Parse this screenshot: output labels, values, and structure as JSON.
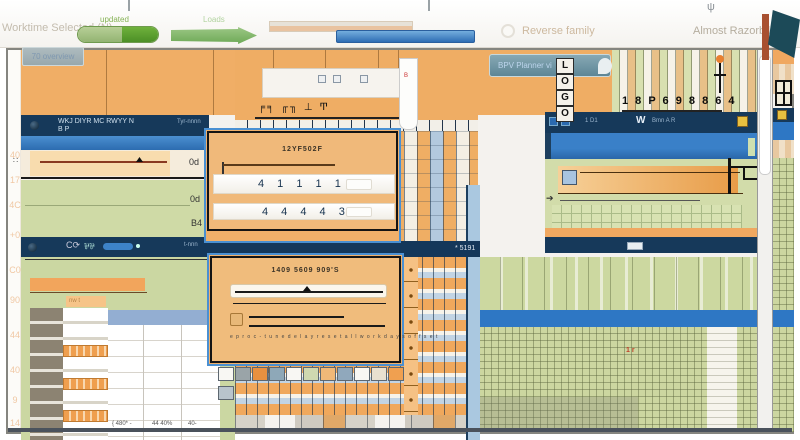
{
  "toolbar": {
    "selected_label": "Worktime Selected (N)",
    "progress_caption": "updated",
    "arrow_caption": "Loads",
    "reverse_label": "Reverse family",
    "about_label": "Almost Razorbillfest",
    "psi_icon": "ψ"
  },
  "gutter": {
    "rows": [
      "40",
      "17",
      "4C",
      "+0",
      "C0",
      "90",
      "44",
      "40",
      "9",
      "14"
    ]
  },
  "left_panel": {
    "header_button": "70 overview",
    "navy1": {
      "line1": "WKJ DIYR MC RWYY N",
      "line2": "B P",
      "right": "Tyr-nnnn"
    },
    "slider_ticks": "∷",
    "slider_value": "0d",
    "green_label_a": "0d",
    "green_label_b": "B4",
    "navy2": {
      "refresh": "C⟳",
      "people": "⅌⅌",
      "right": "t-nnn"
    },
    "tag": "nw t",
    "footer": [
      "{ 480* -",
      "44 40%",
      "40-"
    ]
  },
  "center": {
    "glyph_row": "╒╕ ╓╖ ⊥ Ͳ",
    "navy_text": "* 5191",
    "column_mark": "B"
  },
  "dialog1": {
    "title": "12YF502F",
    "row1": "4 1 1 1 1 3",
    "row2": "4 4 4 4 3"
  },
  "dialog2": {
    "title": "1409 5609 909'S",
    "fine_print": "e p r o c - t u n e   d e l a y   r e s e t   a l l   w o r k   d a y s   o f f s e t"
  },
  "palette_row": [
    "#f8f7f3",
    "#9aa4a8",
    "#e89040",
    "#8ea8b8",
    "#f8f7f3",
    "#cfd8b0",
    "#f0b878",
    "#90a8bc",
    "#f8f7f3",
    "#e8e0d0",
    "#f0a050",
    "#b8c4cc"
  ],
  "right_panel": {
    "button_label": "BPV Planner vi",
    "logo_letters": [
      "L",
      "O",
      "G",
      "O"
    ],
    "glyph_row": "1 8 P 6 9 8 8 6 4",
    "navy_bar": {
      "left": "1 D1",
      "center": "W",
      "mid": "Bmn A R"
    },
    "arrow_glyph": "➔",
    "red_marks": "1 r"
  },
  "colors": {
    "accent_orange": "#efad64",
    "navy": "#16395a",
    "blue": "#2e77c4",
    "green": "#ccd6a0",
    "dialog_tan": "#f0b97a"
  }
}
